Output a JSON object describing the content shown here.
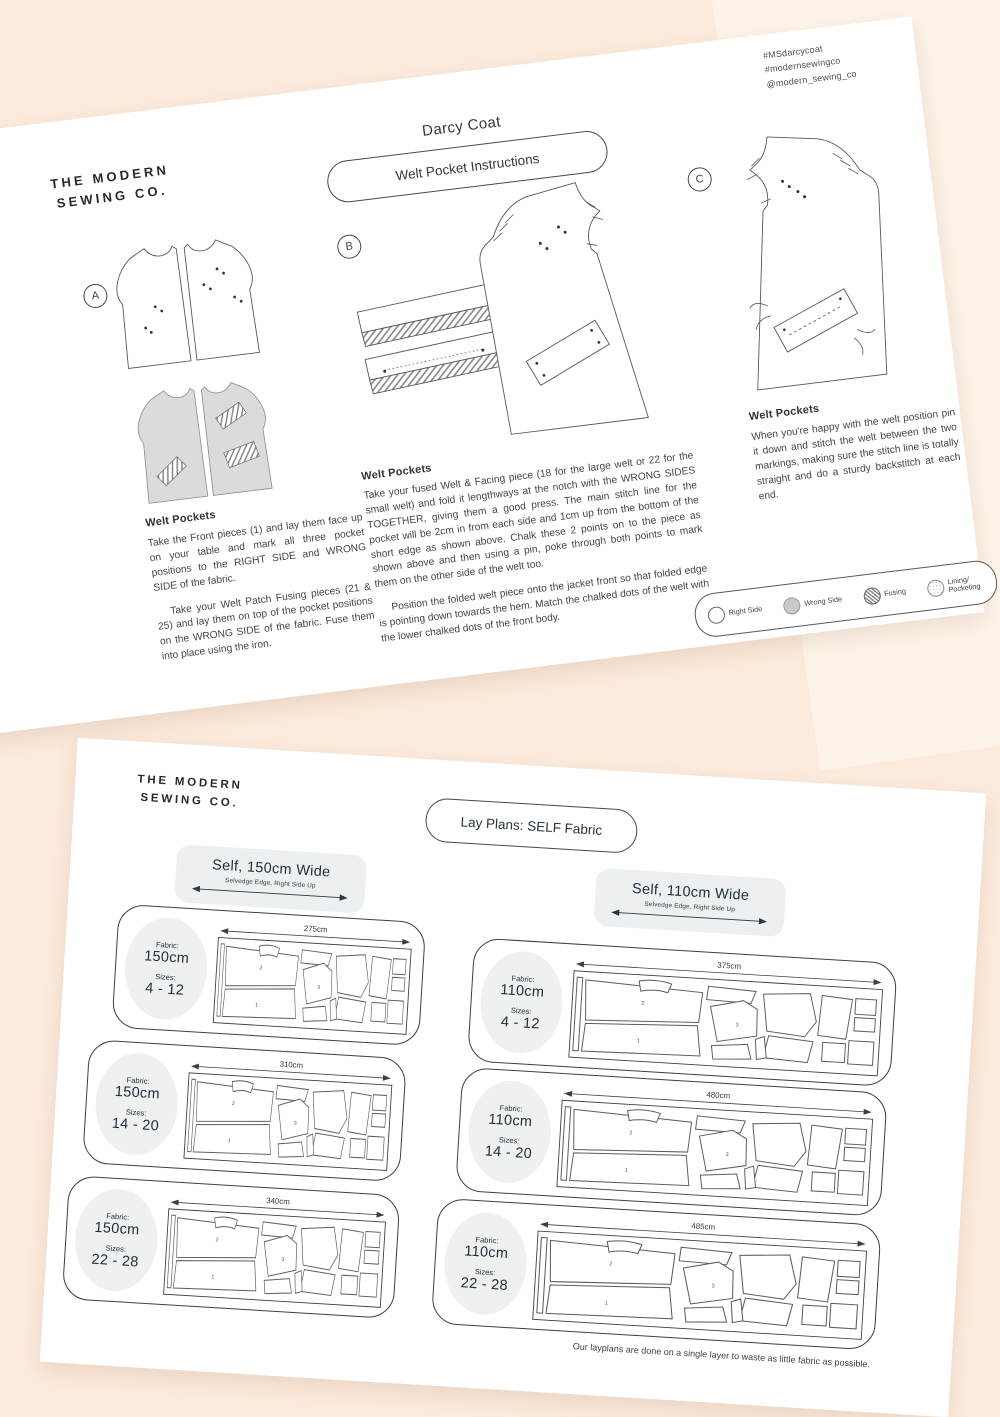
{
  "page1": {
    "hashtags": {
      "line1": "#MSdarcycoat",
      "line2": "#modernsewingco",
      "line3": "@modern_sewing_co"
    },
    "logo": {
      "line1": "THE MODERN",
      "line2": "SEWING CO."
    },
    "title": "Darcy Coat",
    "subtitle": "Welt Pocket Instructions",
    "sections": [
      {
        "letter": "A",
        "heading": "Welt Pockets",
        "p1": "Take the Front pieces (1) and lay them face up on your table and mark all three pocket positions to the RIGHT SIDE and WRONG SIDE of the fabric.",
        "p2": "Take your Welt Patch Fusing pieces (21 & 25) and lay them on top of the pocket positions on the WRONG SIDE of the fabric. Fuse them into place using the iron."
      },
      {
        "letter": "B",
        "heading": "Welt Pockets",
        "p1": "Take your fused Welt & Facing piece (18 for the large welt or 22 for the small welt) and fold it lengthways at the notch with the WRONG SIDES TOGETHER, giving them a good press. The main stitch line for the pocket will be 2cm in from each side and 1cm up from the bottom of the short edge as shown above. Chalk these 2 points on to the piece as shown above and then using a pin, poke through both points to mark them on the other side of the welt too.",
        "p2": "Position the folded welt piece onto the jacket front so that folded edge is pointing down towards the hem. Match the chalked dots of the welt with the lower chalked dots of the front body."
      },
      {
        "letter": "C",
        "heading": "Welt Pockets",
        "p1": "When you're happy with the welt position pin it down and stitch the welt between the two markings, making sure the stitch line is totally straight and do a sturdy backstitch at each end."
      }
    ],
    "legend": {
      "right_side": "Right Side",
      "wrong_side": "Wrong Side",
      "fusing": "Fusing",
      "lining": "Lining/ Pocketing"
    }
  },
  "page2": {
    "logo": {
      "line1": "THE MODERN",
      "line2": "SEWING CO."
    },
    "title": "Lay Plans: SELF Fabric",
    "columns": [
      {
        "header": "Self, 150cm Wide",
        "selvedge": "Selvedge Edge, Right Side Up",
        "plans": [
          {
            "fabric_label": "Fabric:",
            "fabric": "150cm",
            "sizes_label": "Sizes:",
            "sizes": "4 - 12",
            "length": "275cm"
          },
          {
            "fabric_label": "Fabric:",
            "fabric": "150cm",
            "sizes_label": "Sizes:",
            "sizes": "14 - 20",
            "length": "310cm"
          },
          {
            "fabric_label": "Fabric:",
            "fabric": "150cm",
            "sizes_label": "Sizes:",
            "sizes": "22 - 28",
            "length": "340cm"
          }
        ]
      },
      {
        "header": "Self, 110cm Wide",
        "selvedge": "Selvedge Edge, Right Side Up",
        "plans": [
          {
            "fabric_label": "Fabric:",
            "fabric": "110cm",
            "sizes_label": "Sizes:",
            "sizes": "4 - 12",
            "length": "375cm"
          },
          {
            "fabric_label": "Fabric:",
            "fabric": "110cm",
            "sizes_label": "Sizes:",
            "sizes": "14 - 20",
            "length": "480cm"
          },
          {
            "fabric_label": "Fabric:",
            "fabric": "110cm",
            "sizes_label": "Sizes:",
            "sizes": "22 - 28",
            "length": "485cm"
          }
        ]
      }
    ],
    "piece_numbers": {
      "n1": "1",
      "n2": "2",
      "n3": "3"
    },
    "footnote": "Our layplans are done on a single layer to waste as little fabric as possible."
  }
}
